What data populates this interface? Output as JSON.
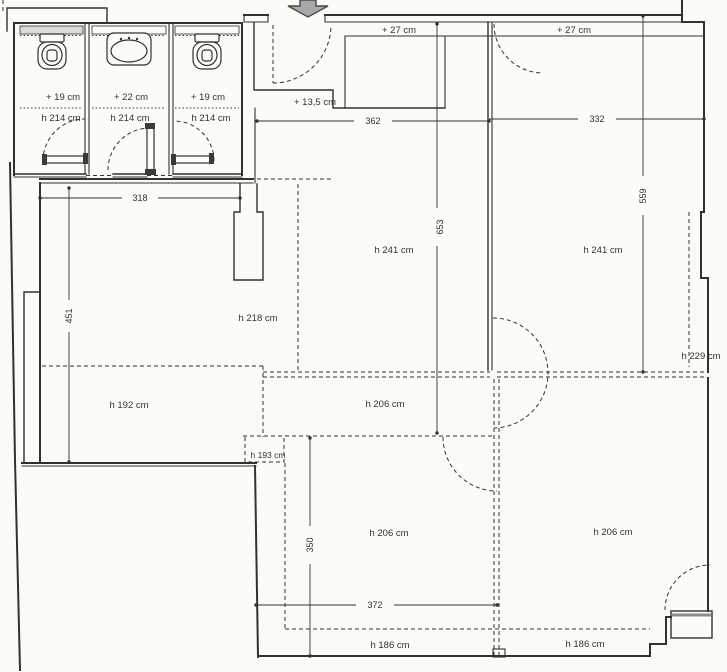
{
  "document": {
    "kind": "scanned architectural floor plan"
  },
  "colors": {
    "ink": "#343230",
    "paper": "#fcfbf8",
    "arrow_fill": "#a8a8a8",
    "band_fill": "#dcdad4"
  },
  "icons": {
    "entrance_arrow": "down-arrow",
    "toilet_left": "toilet",
    "sink_center": "sink",
    "toilet_right": "toilet"
  },
  "stalls": [
    {
      "platform_offset": "+ 19 cm",
      "ceiling_height": "h 214 cm",
      "fixture": "toilet"
    },
    {
      "platform_offset": "+ 22 cm",
      "ceiling_height": "h 214 cm",
      "fixture": "sink"
    },
    {
      "platform_offset": "+ 19 cm",
      "ceiling_height": "h 214 cm",
      "fixture": "toilet"
    }
  ],
  "steps": {
    "top_left": "+ 27 cm",
    "top_right": "+ 27 cm",
    "entry": "+ 13,5 cm"
  },
  "heights": {
    "hall_left": "h 241 cm",
    "hall_right": "h 241 cm",
    "mid_left": "h 218 cm",
    "lower_left": "h 192 cm",
    "mid_center": "h 206 cm",
    "niche": "h 193 cm",
    "right_edge": "h 229 cm",
    "bottom_center": "h 206 cm",
    "bottom_right": "h 206 cm",
    "strip_left": "h 186 cm",
    "strip_right": "h 186 cm"
  },
  "dims": {
    "corridor_width": "318",
    "hall_left_width": "362",
    "hall_right_width": "332",
    "left_room_depth": "451",
    "hall_depth": "653",
    "right_room_depth": "559",
    "bottom_room_depth": "350",
    "bottom_room_width": "372"
  }
}
